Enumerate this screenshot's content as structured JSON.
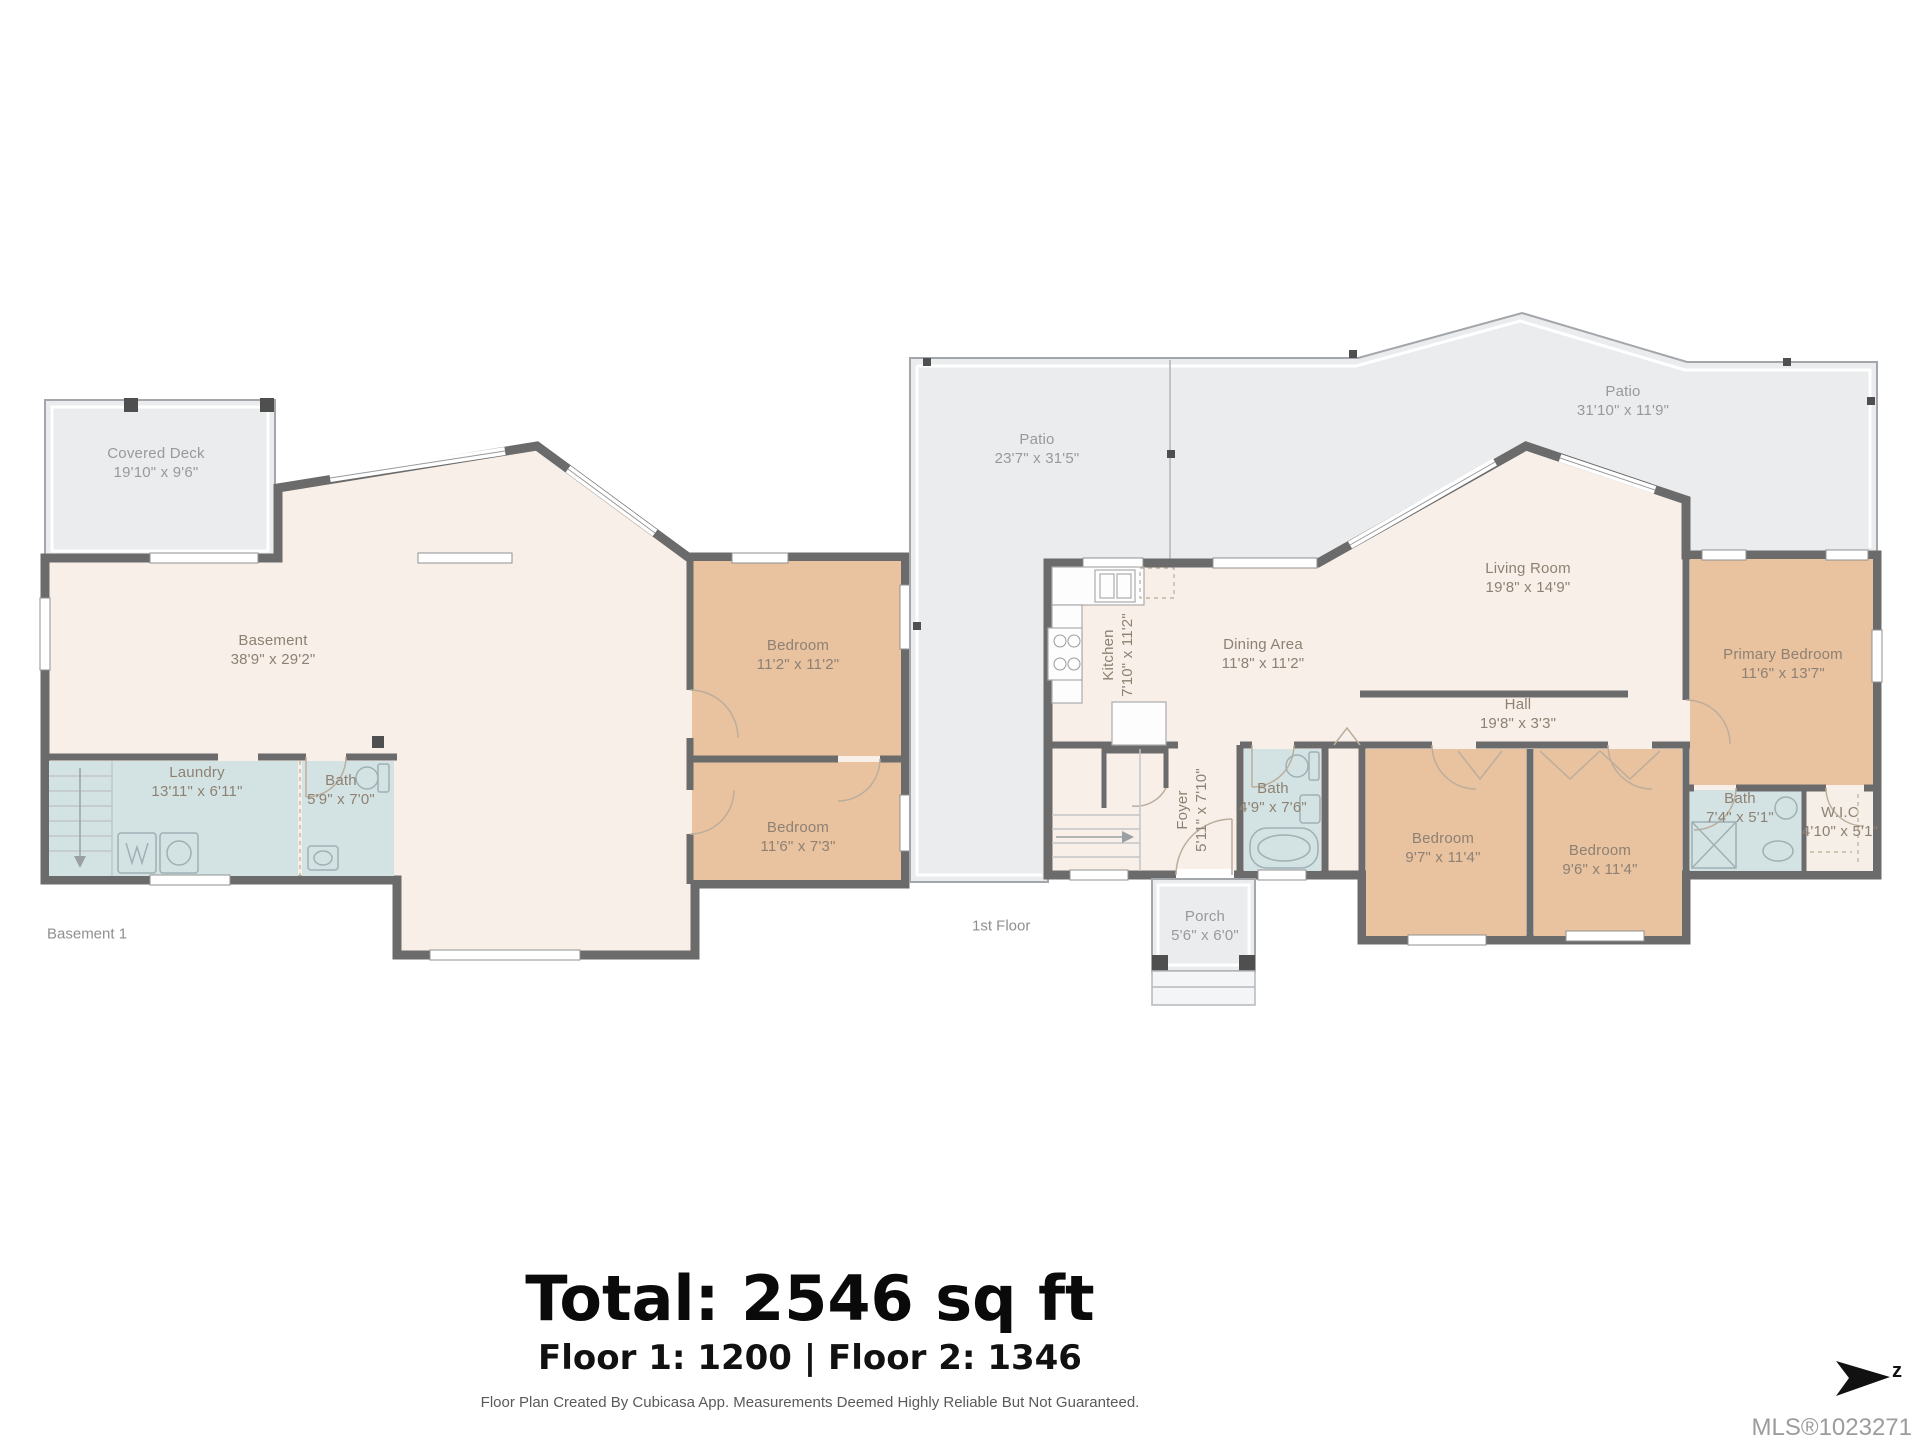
{
  "plans": {
    "basement": {
      "floor_label": "Basement 1",
      "rooms": {
        "covered_deck": {
          "name": "Covered Deck",
          "dims": "19'10\" x 9'6\""
        },
        "basement": {
          "name": "Basement",
          "dims": "38'9\" x 29'2\""
        },
        "laundry": {
          "name": "Laundry",
          "dims": "13'11\" x 6'11\""
        },
        "bath": {
          "name": "Bath",
          "dims": "5'9\" x 7'0\""
        },
        "bedroom_upper": {
          "name": "Bedroom",
          "dims": "11'2\" x 11'2\""
        },
        "bedroom_lower": {
          "name": "Bedroom",
          "dims": "11'6\" x 7'3\""
        }
      }
    },
    "first_floor": {
      "floor_label": "1st Floor",
      "rooms": {
        "patio_left": {
          "name": "Patio",
          "dims": "23'7\" x 31'5\""
        },
        "patio_right": {
          "name": "Patio",
          "dims": "31'10\" x 11'9\""
        },
        "living_room": {
          "name": "Living Room",
          "dims": "19'8\" x 14'9\""
        },
        "kitchen": {
          "name": "Kitchen",
          "dims": "7'10\" x 11'2\""
        },
        "dining_area": {
          "name": "Dining Area",
          "dims": "11'8\" x 11'2\""
        },
        "hall": {
          "name": "Hall",
          "dims": "19'8\" x 3'3\""
        },
        "primary_bedroom": {
          "name": "Primary Bedroom",
          "dims": "11'6\" x 13'7\""
        },
        "foyer": {
          "name": "Foyer",
          "dims": "5'11\" x 7'10\""
        },
        "bath_main": {
          "name": "Bath",
          "dims": "4'9\" x 7'6\""
        },
        "bedroom_left": {
          "name": "Bedroom",
          "dims": "9'7\" x 11'4\""
        },
        "bedroom_right": {
          "name": "Bedroom",
          "dims": "9'6\" x 11'4\""
        },
        "bath_ensuite": {
          "name": "Bath",
          "dims": "7'4\" x 5'1\""
        },
        "wic": {
          "name": "W.I.C",
          "dims": "4'10\" x 5'1\""
        },
        "porch": {
          "name": "Porch",
          "dims": "5'6\" x 6'0\""
        }
      }
    }
  },
  "summary": {
    "total": "Total: 2546 sq ft",
    "floors": "Floor 1: 1200 | Floor 2: 1346",
    "disclaimer": "Floor Plan Created By Cubicasa App. Measurements Deemed Highly Reliable But Not Guaranteed.",
    "mls": "MLS®1023271",
    "compass_letter": "z"
  },
  "colors": {
    "wall": "#6b6b6b",
    "interior": "#f8efe9",
    "bedroom": "#e9c29f",
    "bath": "#d3e3e4",
    "outdoor": "#eaecee",
    "label": "#8e8173"
  }
}
